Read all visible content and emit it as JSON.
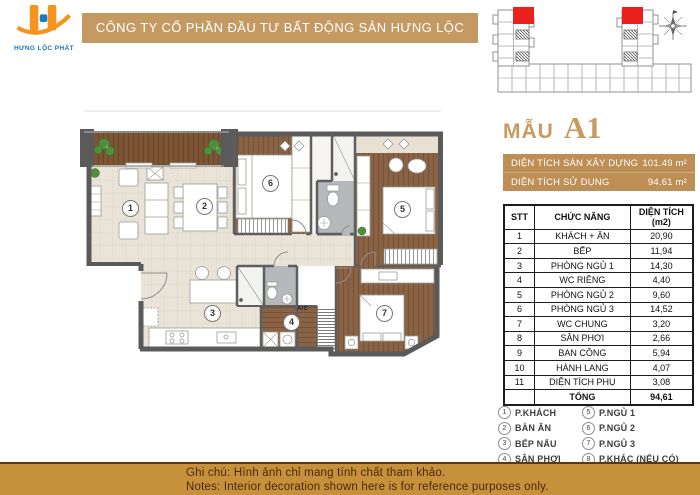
{
  "brand": {
    "logo_text": "HƯNG LỘC PHÁT"
  },
  "header": {
    "company": "CÔNG TY CỔ PHẦN ĐẦU TƯ BẤT ĐỘNG SẢN HƯNG LỘC PHÁT"
  },
  "unit": {
    "label_prefix": "MẪU",
    "code": "A1"
  },
  "metrics": {
    "rows": [
      {
        "label": "DIỆN TÍCH SÀN XÂY DỰNG",
        "value": "101.49 m²"
      },
      {
        "label": "DIỆN TÍCH SỬ DỤNG",
        "value": "94.61 m²"
      }
    ]
  },
  "area_table": {
    "headers": {
      "stt": "STT",
      "func": "CHỨC NĂNG",
      "area": "DIỆN TÍCH (m2)"
    },
    "rows": [
      {
        "stt": "1",
        "name": "KHÁCH + ĂN",
        "area": "20,90"
      },
      {
        "stt": "2",
        "name": "BẾP",
        "area": "11,94"
      },
      {
        "stt": "3",
        "name": "PHÒNG NGỦ 1",
        "area": "14,30"
      },
      {
        "stt": "4",
        "name": "WC RIÊNG",
        "area": "4,40"
      },
      {
        "stt": "5",
        "name": "PHÒNG NGỦ 2",
        "area": "9,60"
      },
      {
        "stt": "6",
        "name": "PHÒNG NGỦ 3",
        "area": "14,52"
      },
      {
        "stt": "7",
        "name": "WC CHUNG",
        "area": "3,20"
      },
      {
        "stt": "8",
        "name": "SÂN PHƠI",
        "area": "2,66"
      },
      {
        "stt": "9",
        "name": "BAN CÔNG",
        "area": "5,94"
      },
      {
        "stt": "10",
        "name": "HÀNH LANG",
        "area": "4,07"
      },
      {
        "stt": "11",
        "name": "DIỆN TÍCH PHỤ",
        "area": "3,08"
      }
    ],
    "total": {
      "label": "TỔNG",
      "value": "94,61"
    }
  },
  "legend": {
    "items": [
      {
        "num": "1",
        "label": "P.KHÁCH"
      },
      {
        "num": "2",
        "label": "BÀN ĂN"
      },
      {
        "num": "3",
        "label": "BẾP NẤU"
      },
      {
        "num": "4",
        "label": "SÂN PHƠI"
      },
      {
        "num": "5",
        "label": "P.NGỦ 1"
      },
      {
        "num": "6",
        "label": "P.NGỦ 2"
      },
      {
        "num": "7",
        "label": "P.NGỦ 3"
      },
      {
        "num": "8",
        "label": "P.KHÁC (NẾU CÓ)"
      }
    ]
  },
  "plan": {
    "room_numbers": [
      "1",
      "2",
      "3",
      "4",
      "5",
      "6",
      "7"
    ],
    "ac_label": "A/C"
  },
  "footer": {
    "line1": "Ghi chú: Hình ảnh chỉ mang tính chất tham khảo.",
    "line2": "Notes: Interior decoration shown here is for reference purposes only."
  },
  "colors": {
    "header_bar": "#c59a62",
    "metric_bar": "#bd8f55",
    "footer_bar": "#c7913c",
    "accent_text": "#c79b60",
    "logo_orange": "#f7941d",
    "logo_blue": "#1b75bb",
    "highlight_unit_red": "#e8211d"
  }
}
